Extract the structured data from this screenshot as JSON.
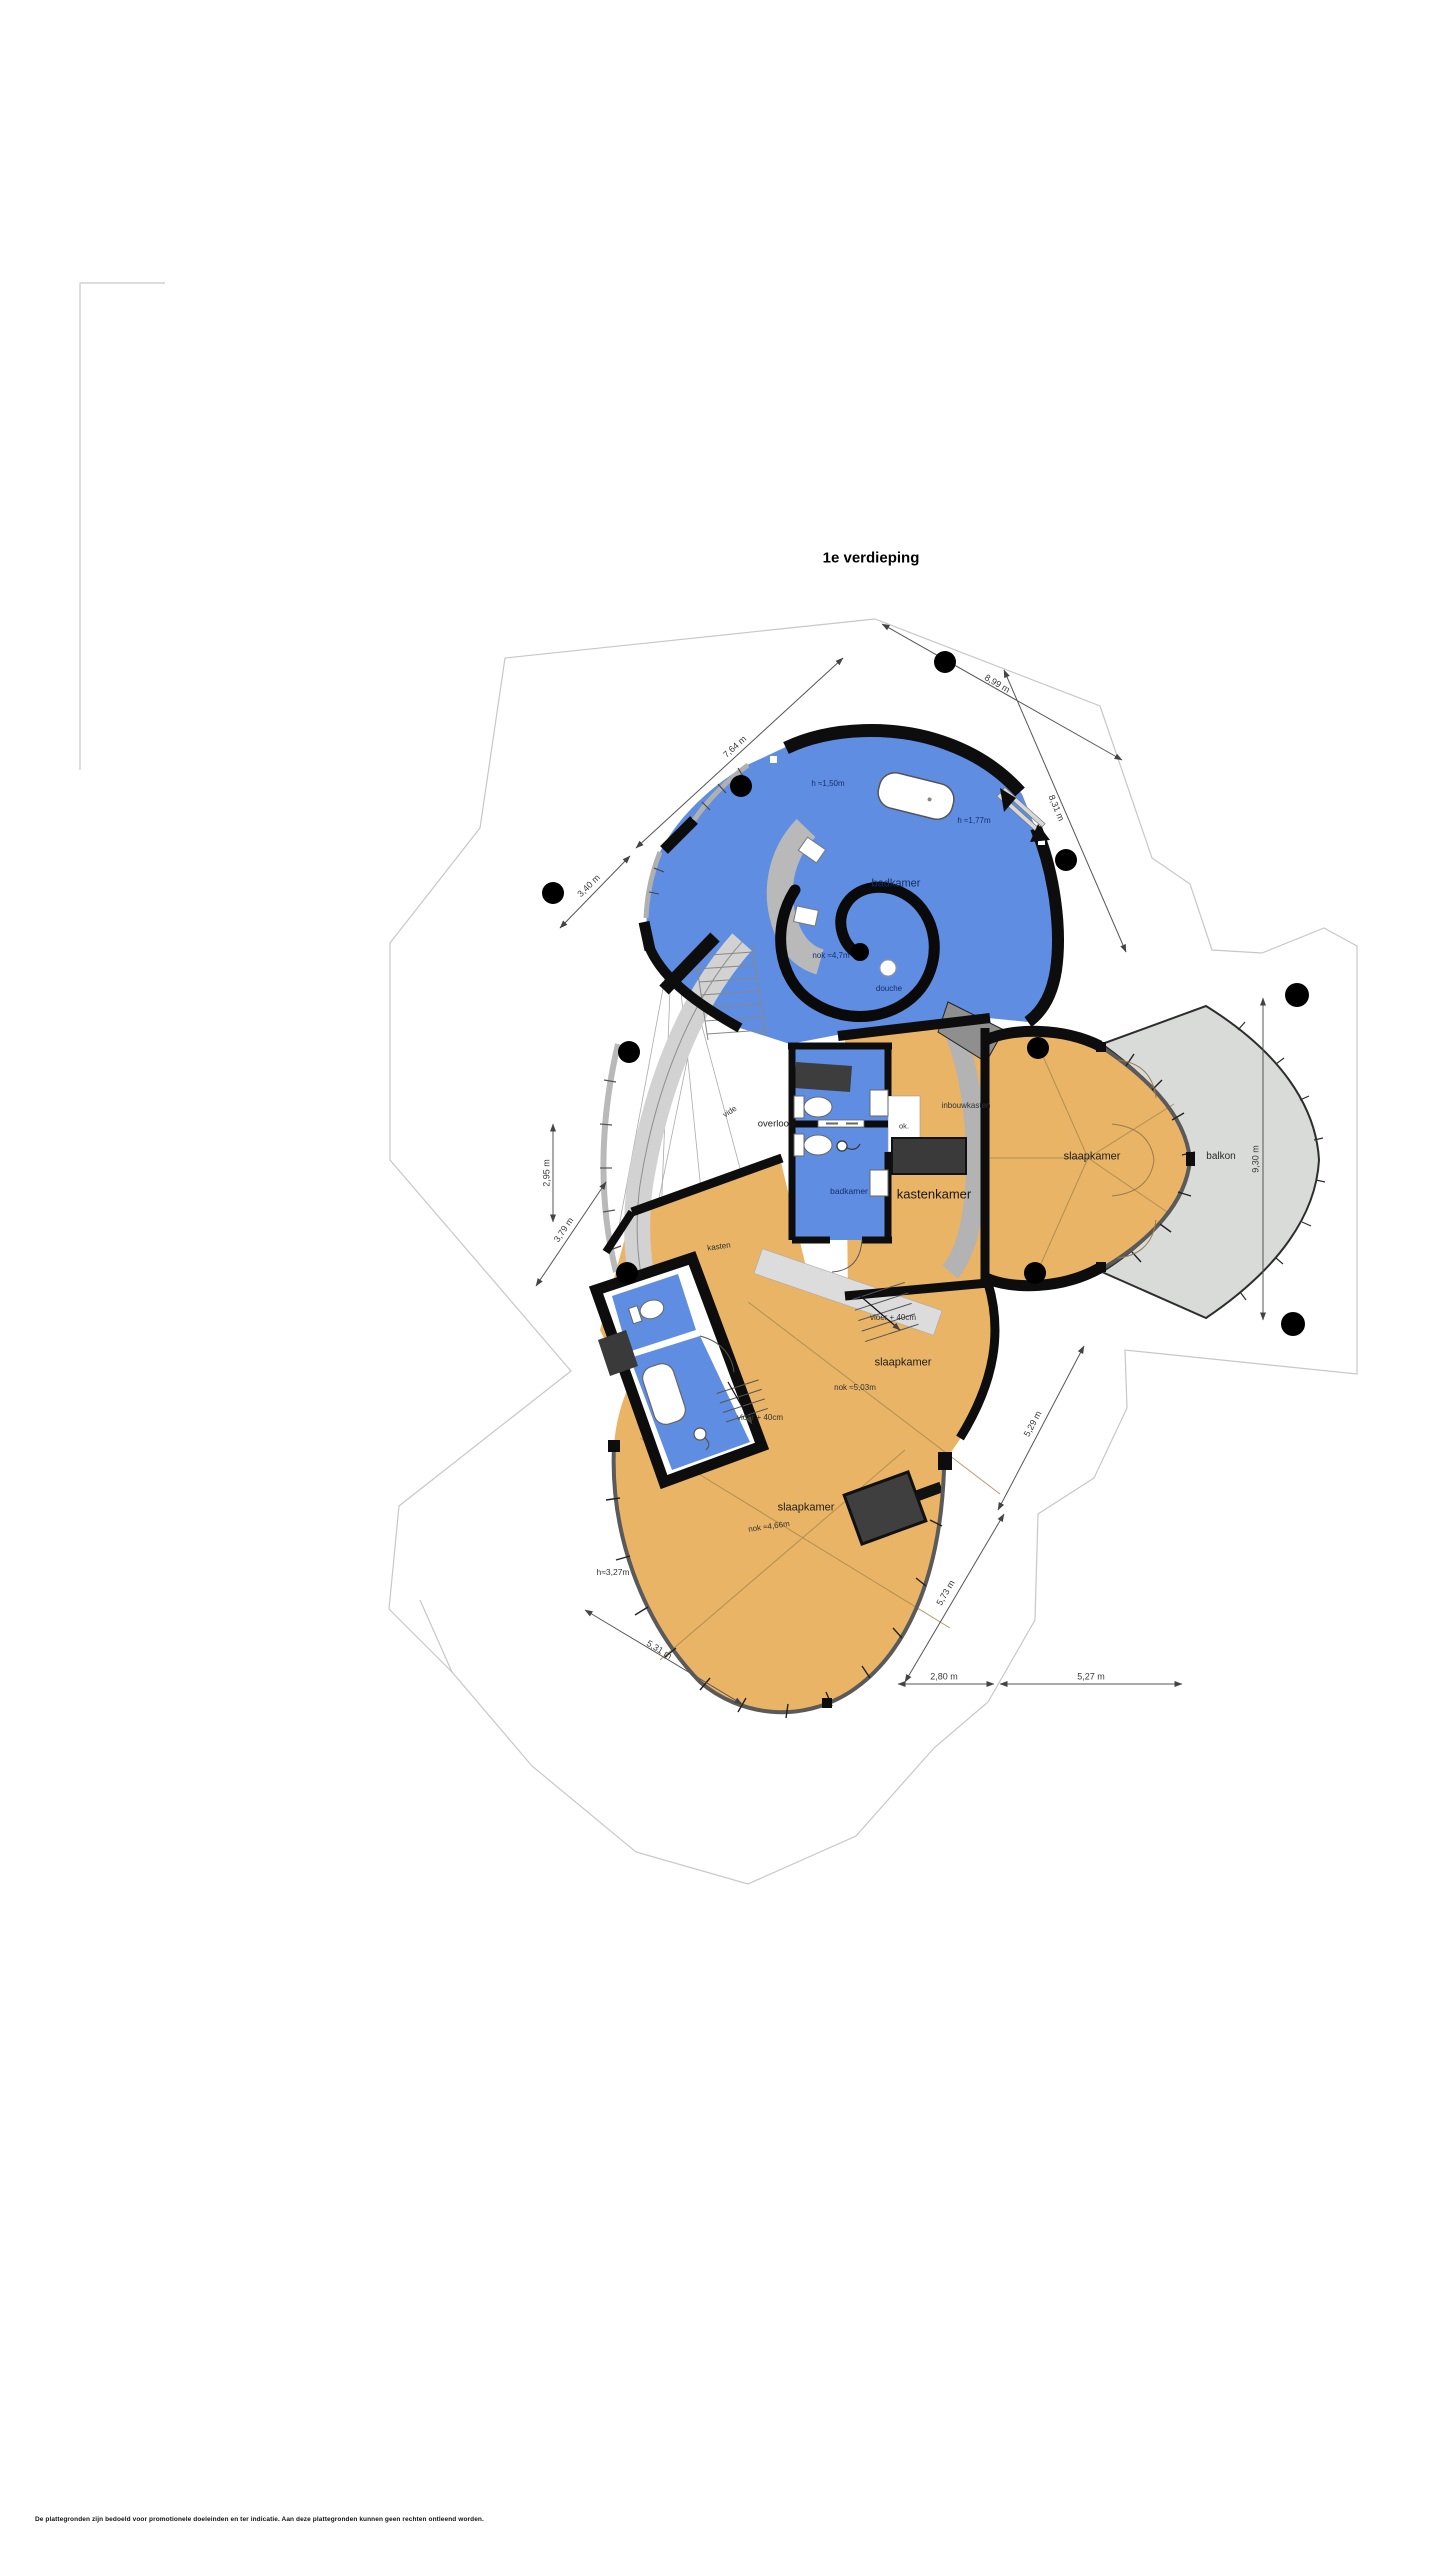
{
  "title": "1e verdieping",
  "colors": {
    "room_orange": "#e9b465",
    "room_blue": "#5f8de2",
    "balcony_gray": "#d8dbd7",
    "wall_black": "#0d0d0d",
    "band_gray": "#b5b5b5"
  },
  "rooms": {
    "badkamer_main": "badkamer",
    "douche": "douche",
    "overloop": "overloop",
    "vide": "vide",
    "wc_badkamer": "badkamer",
    "ok_niche": "ok.",
    "kastenkamer": "kastenkamer",
    "inbouwkasten": "inbouwkasten",
    "kasten": "kasten",
    "slaapkamer_right": "slaapkamer",
    "balkon": "balkon",
    "slaapkamer_mid": "slaapkamer",
    "slaapkamer_bottom": "slaapkamer"
  },
  "annotations": {
    "h_150": "h ≈1,50m",
    "h_177": "h ≈1,77m",
    "nok_47": "nok ≈4,7m",
    "nok_503": "nok ≈5,03m",
    "nok_466": "nok ≈4,66m",
    "h_327": "h≈3,27m",
    "vloer_40_upper": "vloer + 40cm",
    "vloer_40_lower": "vloer + 40cm"
  },
  "dimensions": {
    "d_899": "8,99 m",
    "d_764": "7,64 m",
    "d_340": "3,40 m",
    "d_831": "8,31 m",
    "d_295": "2,95 m",
    "d_379": "3,79 m",
    "d_930": "9,30 m",
    "d_529": "5,29 m",
    "d_573": "5,73 m",
    "d_280": "2,80 m",
    "d_527": "5,27 m",
    "d_531": "5,31 m"
  },
  "footer": {
    "disclaimer": "De plattegronden zijn bedoeld voor promotionele doeleinden en ter indicatie. Aan deze plattegronden kunnen geen rechten ontleend worden."
  }
}
